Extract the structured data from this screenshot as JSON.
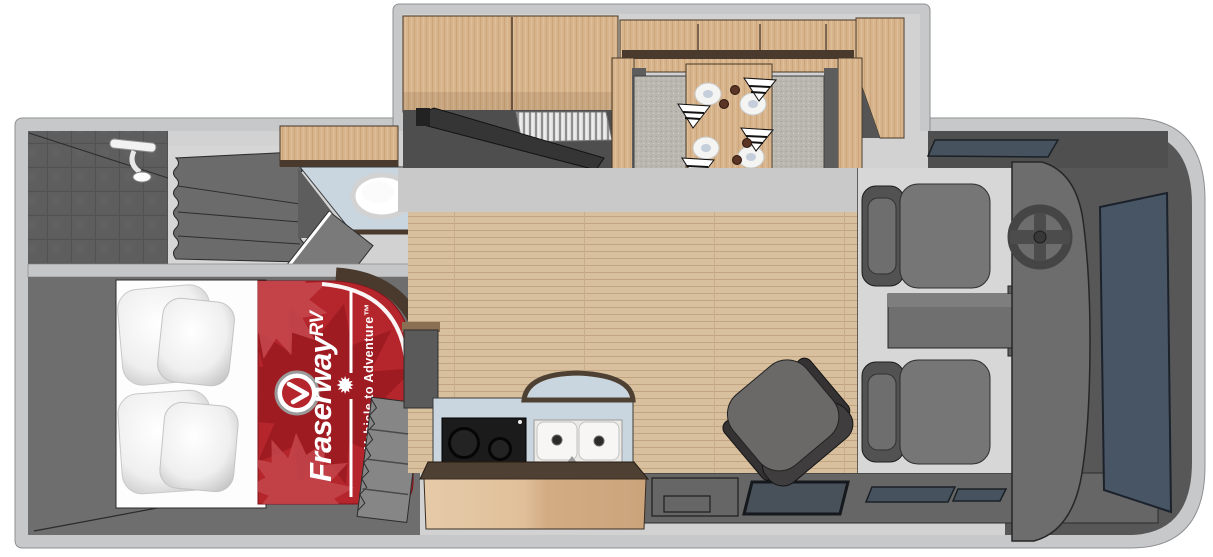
{
  "branding": {
    "logo_name": "Fraserway",
    "logo_suffix": "RV",
    "tagline": "Your Vehicle to Adventure™"
  },
  "scene": {
    "type": "3D overhead floor plan rendering of a Class C motorhome",
    "rooms": [
      "bedroom",
      "bathroom",
      "kitchen",
      "dinette",
      "cab",
      "entry"
    ],
    "furnishings": [
      "bed-with-four-pillows",
      "fraserway-branded-bedspread",
      "shower-with-showerhead",
      "shower-curtain",
      "toilet",
      "vanity-sink",
      "overhead-cabinets",
      "tv-on-swivel-bracket",
      "tambour-appliance-garage",
      "dinette-table-with-four-place-settings",
      "two-dinette-benches",
      "two-burner-cooktop",
      "double-kitchen-sink",
      "swivel-chair",
      "driver-seat",
      "passenger-seat",
      "steering-wheel",
      "dashboard",
      "windshield",
      "entry-step",
      "door-window"
    ]
  },
  "colors": {
    "shell_gray": "#c7c8c9",
    "interior_wall_gray": "#5f5f5f",
    "floor_wood_tan": "#d8c09f",
    "cabinet_wood": "#d3ac84",
    "counter_blue_gray": "#c9d5df",
    "counter_trim_brown": "#4e4134",
    "brand_red": "#b5262c",
    "maple_leaf_red": "#9e1b21",
    "windshield_slate": "#475565",
    "bench_cushion_gray": "#bab7b1",
    "seat_gray": "#757575"
  }
}
